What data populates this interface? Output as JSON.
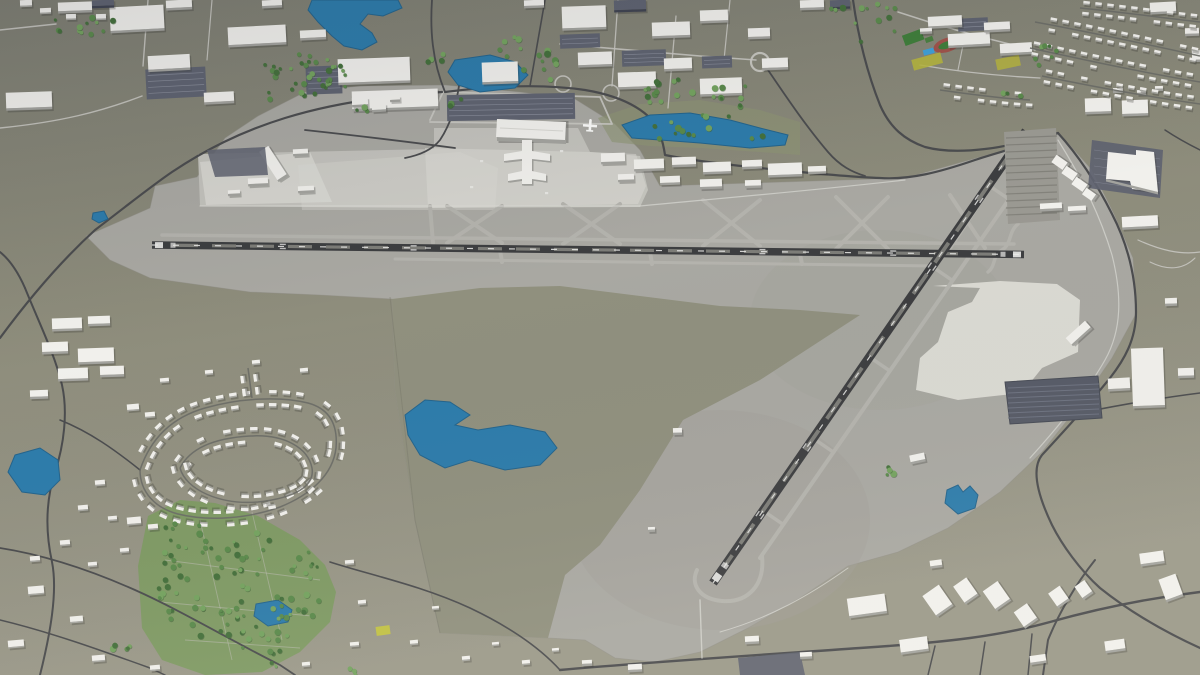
{
  "scene": {
    "type": "3d-aerial-map-render",
    "description": "Aerial 3D model rendering of a regional airport with two crossing runways, a terminal with pier concourse, cargo buildings, and surrounding suburbs, industry, forest park, lakes and road network"
  },
  "palette": {
    "terrain": "#8d8c7b",
    "terrain_dark": "#7e7e72",
    "terrain_light": "#9b998a",
    "airport_pavement": "#a9a8a2",
    "airport_pavement_dark": "#a19f99",
    "apron_bright": "#c3c2bc",
    "patch_white": "#dddcd6",
    "runway_dark": "#3d3e40",
    "runway_worn": "#8d8d86",
    "runway_marks": "#ececea",
    "taxiway": "#b4b3ad",
    "service_road": "#dcdbd5",
    "road_dark": "#4b4c4e",
    "road_light": "#c9c8c2",
    "street": "#6a6b66",
    "water": "#2d7cab",
    "water_edge": "#24648c",
    "tree_dark": "#44703b",
    "tree_mid": "#5a8a4b",
    "tree_light": "#74a35f",
    "grass_park": "#7d9a62",
    "lakeside_green": "#8e9573",
    "building_top": "#f1f0ec",
    "building_side": "#a3a39e",
    "building_dark": "#5e6270",
    "building_dark_side": "#3f4350",
    "parking_dark": "#5f6370",
    "parking_lines": "#8f93a0",
    "lot_medium": "#9a9992",
    "lot_medium_lines": "#7e7d76",
    "solar_dark": "#565a66",
    "sports_green": "#3f7e3a",
    "sports_track": "#a0524a",
    "sports_pool": "#3fa0d8",
    "field_yellow": "#b9b73a"
  },
  "features": {
    "airport": [
      "main-runway",
      "crosswind-runway",
      "parallel-taxiways",
      "terminal-building",
      "concourse-pier",
      "parked-aircraft",
      "terminal-parking-lot",
      "cargo-warehouses",
      "west-apron-hangars",
      "east-apron-lot",
      "bare-concrete-patch",
      "grass-infield"
    ],
    "surroundings": [
      "industrial-park-northwest",
      "industrial-park-north",
      "school-campus",
      "sports-field",
      "running-track",
      "swimming-pool",
      "residential-neighborhood-southwest",
      "residential-neighborhood-northeast",
      "forest-park",
      "lakes-and-ponds",
      "shopping-center",
      "solar-panel-lot",
      "road-network",
      "roundabout",
      "highway-interchange"
    ]
  }
}
